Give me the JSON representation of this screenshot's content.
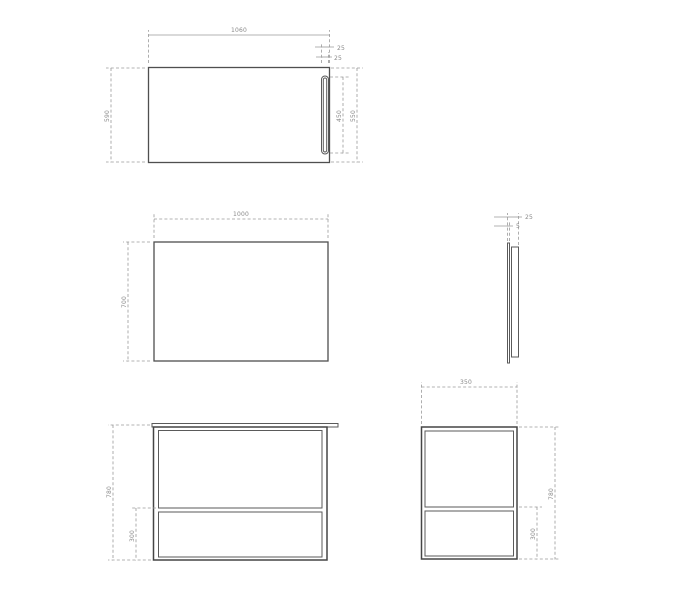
{
  "page": {
    "background": "#ffffff",
    "object_line_color": "#4f4f4f",
    "dimension_line_color": "#9a9a9a",
    "label_color": "#8a8a8a"
  },
  "views": {
    "countertop_top": {
      "width": "1060",
      "depth": "590",
      "slot_length": "450",
      "slot_right_span": "550",
      "slot_width": "25",
      "slot_edge_offset": "25"
    },
    "panel_front": {
      "width": "1000",
      "height": "700"
    },
    "panel_side": {
      "thickness": "25",
      "glass_thickness": "5"
    },
    "stand_front": {
      "height": "780",
      "lower_shelf_height": "300"
    },
    "stand_side": {
      "depth": "350",
      "height": "780",
      "lower_shelf_height": "300"
    }
  }
}
